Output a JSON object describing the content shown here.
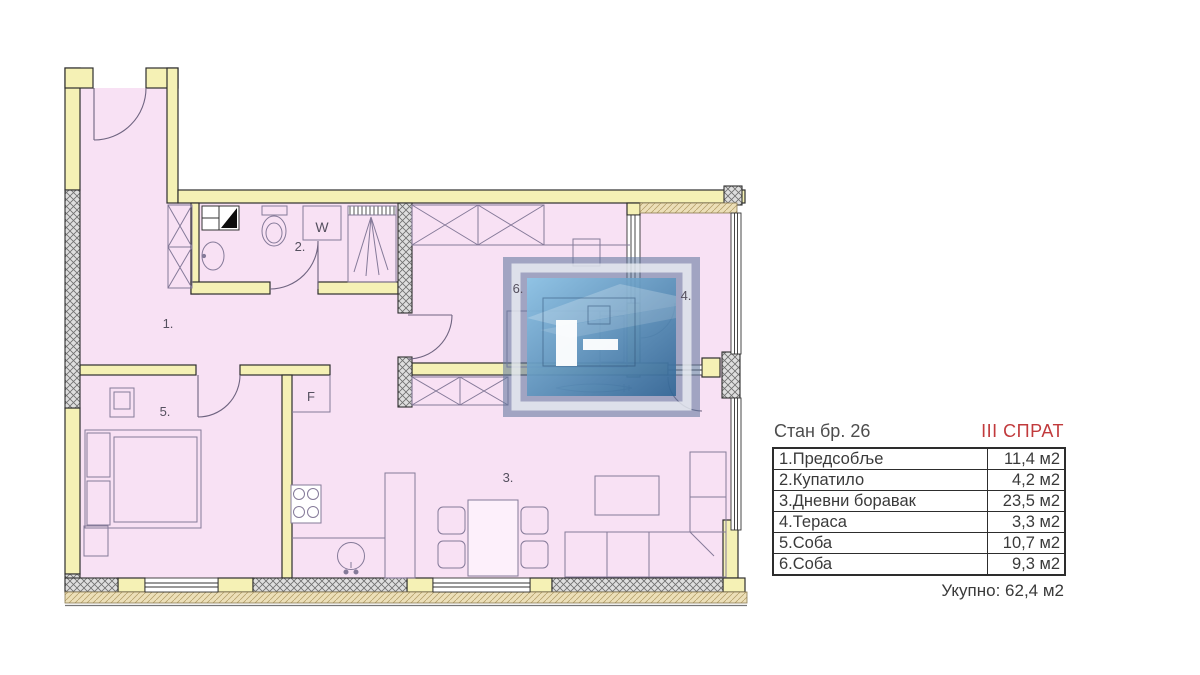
{
  "plan": {
    "room_labels": {
      "r1": "1.",
      "r2": "2.",
      "r3": "3.",
      "r4": "4.",
      "r5": "5.",
      "r6": "6."
    },
    "fixture_labels": {
      "washer": "W",
      "fridge": "F"
    }
  },
  "legend": {
    "title": "Стан бр. 26",
    "floor": "III СПРАТ",
    "rows": [
      {
        "name": "1.Предсобље",
        "area": "11,4 м2"
      },
      {
        "name": "2.Купатило",
        "area": "4,2 м2"
      },
      {
        "name": "3.Дневни боравак",
        "area": "23,5 м2"
      },
      {
        "name": "4.Тераса",
        "area": "3,3 м2"
      },
      {
        "name": "5.Соба",
        "area": "10,7 м2"
      },
      {
        "name": "6.Соба",
        "area": "9,3 м2"
      }
    ],
    "total": "Укупно: 62,4 м2"
  },
  "colors": {
    "floor_fill": "#f8e1f4",
    "wall_fill": "#f5f1b5",
    "floor_label_accent": "#c13a3c",
    "logo_blue": "#3d6fa3"
  }
}
